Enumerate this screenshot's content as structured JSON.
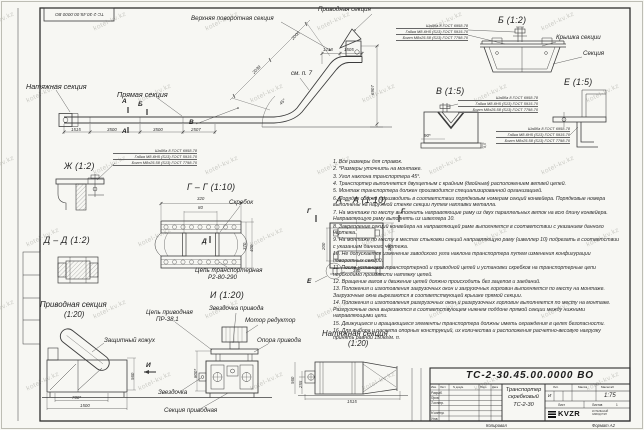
{
  "watermark": {
    "text": "kotel-kv.kz"
  },
  "stamp_rotated": "ТС-2-30.45.00.0000 ВО",
  "fastener_spec": {
    "washer": "Шайба 8 ГОСТ 6958-78",
    "nut": "Гайка М8-6Н5 (S13) ГОСТ 5915-70",
    "bolt": "Болт М8х25.58 (S13) ГОСТ 7798-70"
  },
  "marks": {
    "a": "А",
    "b": "Б",
    "v": "В",
    "g": "Г",
    "d": "Д",
    "e": "Е",
    "i": "И"
  },
  "main_view": {
    "labels": {
      "upper_turn": "Верхняя поворотная секция",
      "drive": "Приводная секция",
      "tension": "Натяжная секция",
      "straight": "Прямая секция",
      "see_note": "см. п. 7"
    },
    "dims": {
      "d1": "1515",
      "d2": "3500",
      "d3": "3500",
      "d4": "2507",
      "top1": "1218",
      "top2": "1505",
      "height": "6907",
      "slope1": "2000",
      "slope2": "2039",
      "angle": "45°"
    }
  },
  "views": {
    "b": {
      "title": "Б (1:2)",
      "cover": "Крышка секции",
      "section": "Секция"
    },
    "v": {
      "title": "В (1:5)",
      "dim": "90*",
      "dim2": "4,5"
    },
    "e": {
      "title": "Е (1:5)"
    },
    "zh": {
      "title": "Ж (1:2)"
    },
    "gg": {
      "title": "Г – Г (1:10)",
      "scraper": "Скребок",
      "chain1": "Цепь транспортерная",
      "chain2": "Р2-80-290",
      "dims": {
        "w": "320",
        "inner": "80",
        "h1": "370",
        "h2": "400"
      }
    },
    "aa": {
      "title": "А – А (1:10)",
      "dims": {
        "inner": "200",
        "outer": "380",
        "width": "340"
      }
    },
    "dd": {
      "title": "Д – Д (1:2)"
    },
    "i": {
      "title": "И (1:20)"
    }
  },
  "drive_section": {
    "title1": "Приводная секция",
    "title2": "(1:20)",
    "chain1": "Цепь приводная",
    "chain2": "ПР-38,1",
    "guard": "Защитный кожух",
    "drive_sprocket": "Звездочка привода",
    "motor": "Мотор редуктор",
    "support": "Опора привода",
    "sprocket": "Звездочка",
    "section": "Секция приводная",
    "dims": {
      "d1": "700*",
      "d2": "1500",
      "d3": "800*",
      "d4": "560"
    }
  },
  "tension_section": {
    "title1": "Натяжная секция",
    "title2": "(1:20)",
    "dims": {
      "h": "560",
      "h2": "255",
      "len": "1515"
    }
  },
  "notes": [
    "1. Все размеры для справок.",
    "2. *Размеры уточнить на монтаже.",
    "3. Угол наклона транспортера 45°.",
    "4. Транспортер выполняется двухцепным с крайним (двойным) расположением ветвей цепей.",
    "5. Монтаж транспортера должен производится специализированной организацией.",
    "6. Порядок сборки производить в соответствии порядковым номерам секций конвейера. Порядковые номера выполнены на наружной стенке секции путем наплавки металла.",
    "7. На монтаже по месту выполнить направляющие раму из двух параллельных веток на всю длину конвейера. Направляющую раму выполнять из швеллера 10.",
    "8. Закрепление секций конвейера на направляющей раме выполняется в соответствии с указанием данного чертежа.",
    "9. На монтаже по месту в местах стыковки секций направляющую раму (швеллер 10) подрезать в соответствии с указанием данного чертежа.",
    "10. Не допускается изменение заводского угла наклона транспортера путем изменения конфигурации поворотных секций.",
    "11. После установки транспортерной и приводной цепей и установки скребков на транспортерные цепи необходимо произвести натяжку цепей.",
    "12. Вращение валов и движение цепей должно происходить без зацепов и заеданий.",
    "13. Положения и изготовления загрузочных окон и загрузочных горловин выполняется по месту на монтаже. Загрузочные окна вырезаются в соответствующей крышке прямой секции.",
    "14. Положения и изготовления разгрузочных окон и разгрузочных горловин выполняется по месту на монтаже. Разгрузочные окна вырезаются в соответствующем нижнем поддоне прямой секции между нижними направляющими цепи.",
    "15. Движущиеся и вращающиеся элементы транспортера должны иметь ограждения в целях безопасности.",
    "16. Для выбора и расчета опорных конструкций, их количества и расположения расчетно-весовую нагрузку принять равной 150кг/м. п."
  ],
  "title_block": {
    "doc_number": "ТС-2-30.45.00.0000 ВО",
    "title1": "Транспортер",
    "title2": "скребковый",
    "title3": "ТС-2-30",
    "header": {
      "izm": "Изм.",
      "list": "Лист",
      "doc": "N докум.",
      "podp": "Подп.",
      "data": "Дата"
    },
    "rows": [
      "Разраб.",
      "Пров.",
      "Т.контр.",
      "Н.контр.",
      "Утв."
    ],
    "lit_label": "Лит.",
    "lit_value": "И",
    "mass_label": "Масса",
    "scale_label": "Масштаб",
    "scale_value": "1:75",
    "sheet_label": "Лист",
    "sheets_label": "Листов",
    "sheets_value": "1",
    "logo": "KVZR",
    "logo_sub1": "КОТЕЛЬНЫЙ",
    "logo_sub2": "ЗАВОД РЭП",
    "kopiroval": "Копировал",
    "format": "Формат А2"
  }
}
